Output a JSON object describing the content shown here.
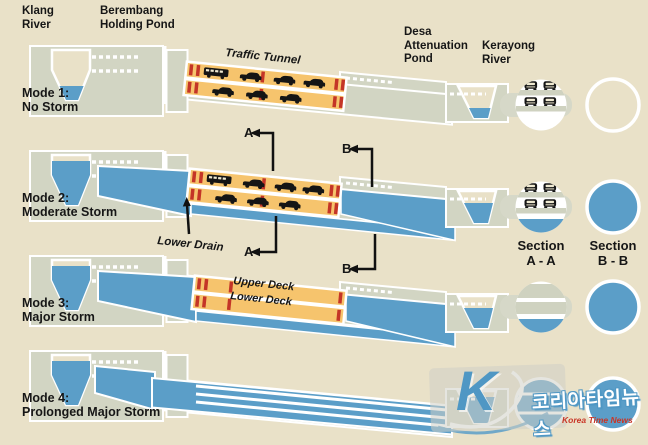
{
  "title": "Stormwater tunnel operating modes diagram",
  "colors": {
    "background": "#e9e1c8",
    "ground": "#d2d5c3",
    "water": "#5b9ec8",
    "traffic_tunnel": "#f6c46d",
    "lane_marking": "#c43527",
    "text": "#161616",
    "watermark_red": "#c93526"
  },
  "headers": {
    "klang_river": "Klang\nRiver",
    "berembang": "Berembang\nHolding Pond",
    "desa": "Desa\nAttenuation\nPond",
    "kerayong": "Kerayong\nRiver"
  },
  "modes": [
    {
      "label": "Mode 1:\nNo Storm"
    },
    {
      "label": "Mode 2:\nModerate Storm"
    },
    {
      "label": "Mode 3:\nMajor Storm"
    },
    {
      "label": "Mode 4:\nProlonged Major Storm"
    }
  ],
  "tunnel": {
    "traffic_tunnel": "Traffic Tunnel",
    "lower_drain": "Lower Drain",
    "upper_deck": "Upper Deck",
    "lower_deck": "Lower Deck"
  },
  "sections": {
    "marker_a": "A",
    "marker_b": "B",
    "a_label": "Section\nA - A",
    "b_label": "Section\nB - B"
  },
  "watermark": {
    "logo_letter": "K",
    "korean": "코리아타임뉴스",
    "english": "Korea Time News"
  }
}
